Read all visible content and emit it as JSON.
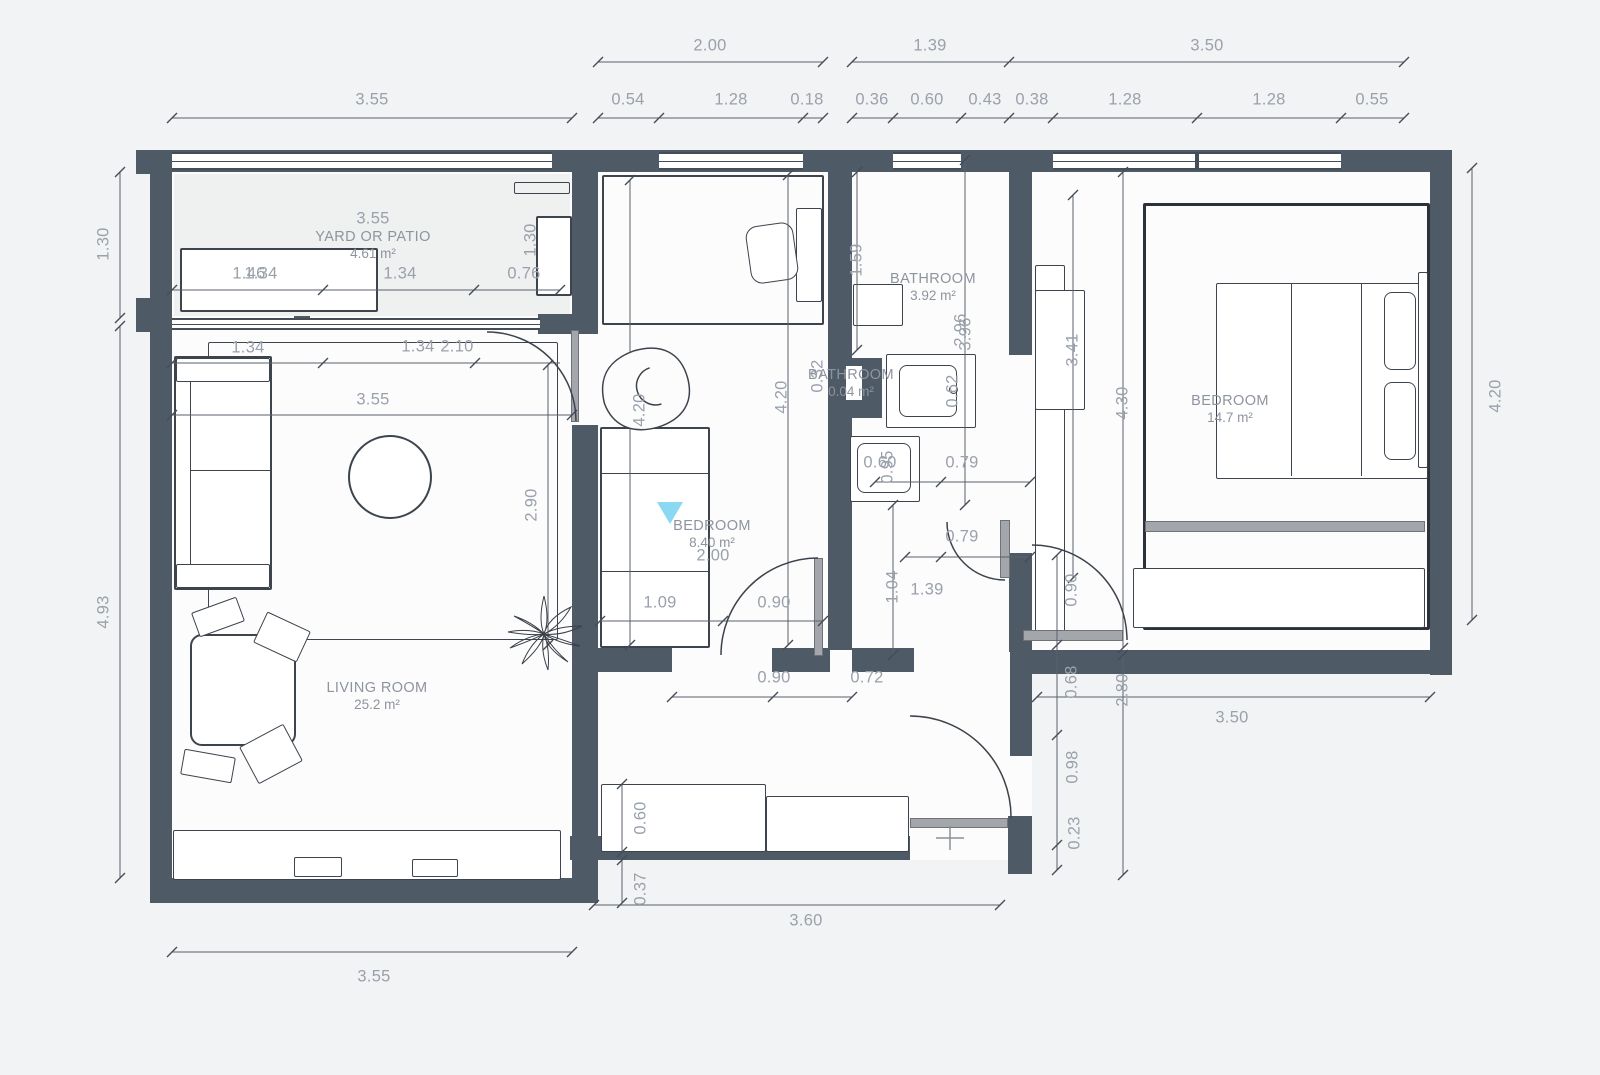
{
  "page": {
    "background": "#f2f3f4",
    "type": "architectural-floor-plan"
  },
  "colors": {
    "wall": "#4e5a66",
    "dimension_text": "#9aa1ab",
    "room_text": "#8e949e",
    "drawing_line": "#3c434b",
    "door_leaf": "#a3a7ab",
    "watermark_accent": "#85d6f2",
    "floor": "#fcfcfd",
    "background": "#f2f3f4"
  },
  "watermark": {
    "icon": "triangle-down-icon",
    "color": "#85d6f2"
  },
  "rooms": [
    {
      "name": "YARD OR PATIO",
      "area": "4.61 m²",
      "x": 373,
      "y": 228
    },
    {
      "name": "BEDROOM",
      "area": "8.40 m²",
      "x": 712,
      "y": 517
    },
    {
      "name": "BATHROOM",
      "area": "3.92 m²",
      "x": 933,
      "y": 270
    },
    {
      "name": "BATHROOM",
      "area": "0.04 m²",
      "x": 851,
      "y": 366
    },
    {
      "name": "BEDROOM",
      "area": "14.7 m²",
      "x": 1230,
      "y": 392
    },
    {
      "name": "LIVING ROOM",
      "area": "25.2 m²",
      "x": 377,
      "y": 679
    }
  ],
  "dim_labels": [
    {
      "t": "2.00",
      "x": 710,
      "y": 46
    },
    {
      "t": "1.39",
      "x": 930,
      "y": 46
    },
    {
      "t": "3.50",
      "x": 1207,
      "y": 46
    },
    {
      "t": "3.55",
      "x": 372,
      "y": 100
    },
    {
      "t": "0.54",
      "x": 628,
      "y": 100
    },
    {
      "t": "1.28",
      "x": 731,
      "y": 100
    },
    {
      "t": "0.18",
      "x": 807,
      "y": 100
    },
    {
      "t": "0.36",
      "x": 872,
      "y": 100
    },
    {
      "t": "0.60",
      "x": 927,
      "y": 100
    },
    {
      "t": "0.43",
      "x": 985,
      "y": 100
    },
    {
      "t": "0.38",
      "x": 1032,
      "y": 100
    },
    {
      "t": "1.28",
      "x": 1125,
      "y": 100
    },
    {
      "t": "1.28",
      "x": 1269,
      "y": 100
    },
    {
      "t": "0.55",
      "x": 1372,
      "y": 100
    },
    {
      "t": "1.30",
      "x": 104,
      "y": 244,
      "o": "v"
    },
    {
      "t": "4.93",
      "x": 104,
      "y": 612,
      "o": "v"
    },
    {
      "t": "3.55",
      "x": 373,
      "y": 219
    },
    {
      "t": "1.46",
      "x": 249,
      "y": 274
    },
    {
      "t": "1.34",
      "x": 261,
      "y": 274
    },
    {
      "t": "1.34",
      "x": 400,
      "y": 274
    },
    {
      "t": "0.76",
      "x": 524,
      "y": 274
    },
    {
      "t": "1.30",
      "x": 531,
      "y": 240,
      "o": "v"
    },
    {
      "t": "1.34",
      "x": 248,
      "y": 348
    },
    {
      "t": "1.34",
      "x": 418,
      "y": 347
    },
    {
      "t": "2.10",
      "x": 457,
      "y": 347
    },
    {
      "t": "3.55",
      "x": 373,
      "y": 400
    },
    {
      "t": "2.90",
      "x": 532,
      "y": 505,
      "o": "v"
    },
    {
      "t": "4.20",
      "x": 640,
      "y": 410,
      "o": "v"
    },
    {
      "t": "4.20",
      "x": 782,
      "y": 397,
      "o": "v"
    },
    {
      "t": "0.32",
      "x": 818,
      "y": 376,
      "o": "v"
    },
    {
      "t": "2.00",
      "x": 713,
      "y": 556
    },
    {
      "t": "1.09",
      "x": 660,
      "y": 603
    },
    {
      "t": "0.90",
      "x": 774,
      "y": 603
    },
    {
      "t": "0.90",
      "x": 774,
      "y": 678
    },
    {
      "t": "0.72",
      "x": 867,
      "y": 678
    },
    {
      "t": "1.04",
      "x": 893,
      "y": 587,
      "o": "v"
    },
    {
      "t": "1.39",
      "x": 927,
      "y": 590
    },
    {
      "t": "1.59",
      "x": 857,
      "y": 260,
      "o": "v"
    },
    {
      "t": "2.96",
      "x": 961,
      "y": 330,
      "o": "v"
    },
    {
      "t": "3.96",
      "x": 966,
      "y": 334,
      "o": "v"
    },
    {
      "t": "0.62",
      "x": 953,
      "y": 391,
      "o": "v"
    },
    {
      "t": "0.60",
      "x": 880,
      "y": 463
    },
    {
      "t": "0.95",
      "x": 888,
      "y": 467,
      "o": "v"
    },
    {
      "t": "0.79",
      "x": 962,
      "y": 463
    },
    {
      "t": "0.79",
      "x": 962,
      "y": 537
    },
    {
      "t": "3.41",
      "x": 1073,
      "y": 350,
      "o": "v"
    },
    {
      "t": "4.30",
      "x": 1123,
      "y": 403,
      "o": "v"
    },
    {
      "t": "4.20",
      "x": 1496,
      "y": 396,
      "o": "v"
    },
    {
      "t": "0.90",
      "x": 1072,
      "y": 590,
      "o": "v"
    },
    {
      "t": "0.68",
      "x": 1072,
      "y": 682,
      "o": "v"
    },
    {
      "t": "2.80",
      "x": 1123,
      "y": 690,
      "o": "v"
    },
    {
      "t": "3.50",
      "x": 1232,
      "y": 718
    },
    {
      "t": "0.98",
      "x": 1073,
      "y": 767,
      "o": "v"
    },
    {
      "t": "0.23",
      "x": 1075,
      "y": 833,
      "o": "v"
    },
    {
      "t": "0.60",
      "x": 641,
      "y": 818,
      "o": "v"
    },
    {
      "t": "0.37",
      "x": 641,
      "y": 889,
      "o": "v"
    },
    {
      "t": "3.60",
      "x": 806,
      "y": 921
    },
    {
      "t": "3.55",
      "x": 374,
      "y": 977
    }
  ]
}
